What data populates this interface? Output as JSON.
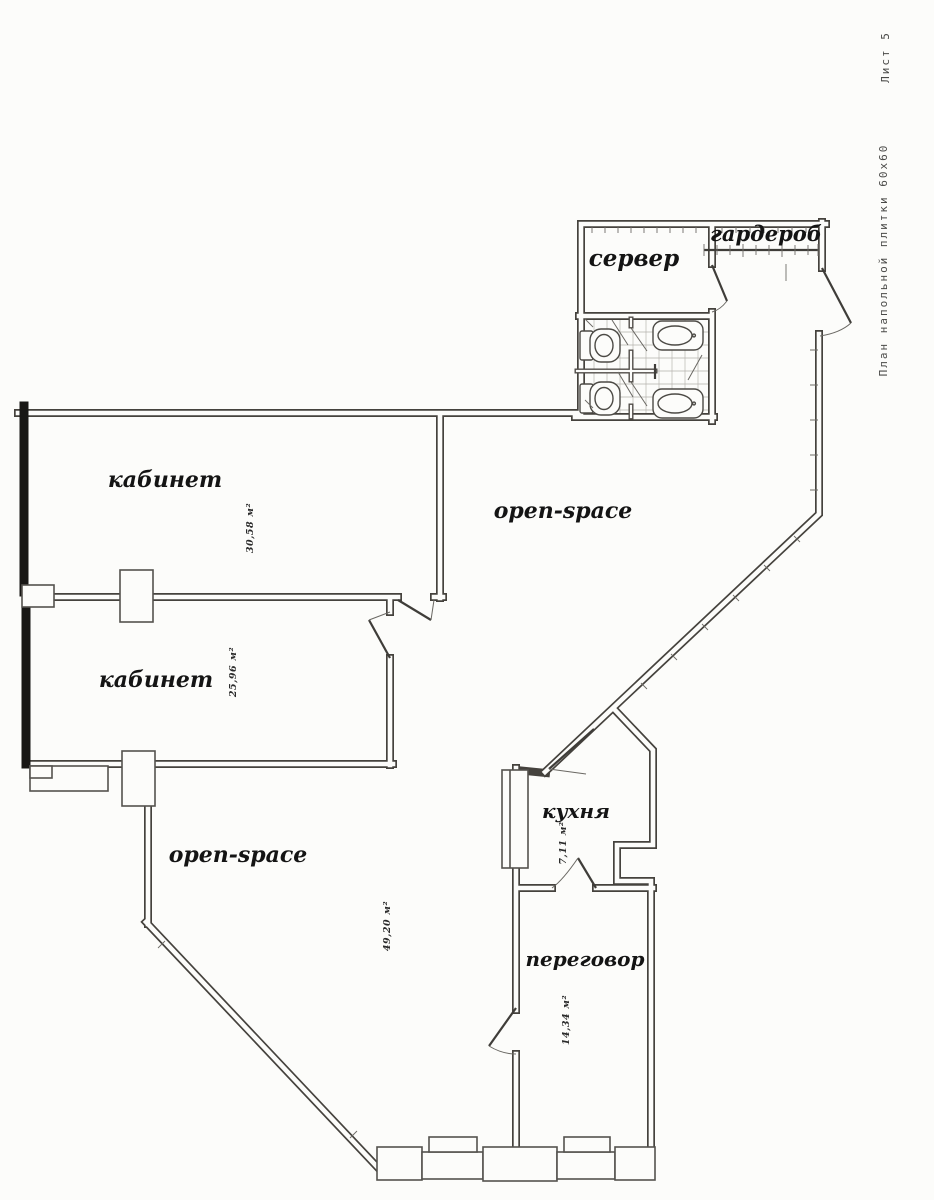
{
  "page": {
    "background": "#fcfcfa",
    "wall_ink": "#45423d",
    "label_ink": "#141414"
  },
  "title_block": {
    "plan_title": "План напольной плитки 60х60",
    "sheet_label": "Лист 5"
  },
  "rooms": [
    {
      "id": "server",
      "label": "сервер",
      "area": ""
    },
    {
      "id": "wardrobe",
      "label": "гардероб",
      "area": ""
    },
    {
      "id": "office-1",
      "label": "кабинет",
      "area": "30,58 м²"
    },
    {
      "id": "office-2",
      "label": "кабинет",
      "area": "25,96 м²"
    },
    {
      "id": "open-space-upper",
      "label": "open-space",
      "area": ""
    },
    {
      "id": "open-space-lower",
      "label": "open-space",
      "area": "49,20 м²"
    },
    {
      "id": "kitchen",
      "label": "кухня",
      "area": "7,11 м²"
    },
    {
      "id": "meeting-room",
      "label": "переговор",
      "area": "14,34 м²"
    }
  ]
}
